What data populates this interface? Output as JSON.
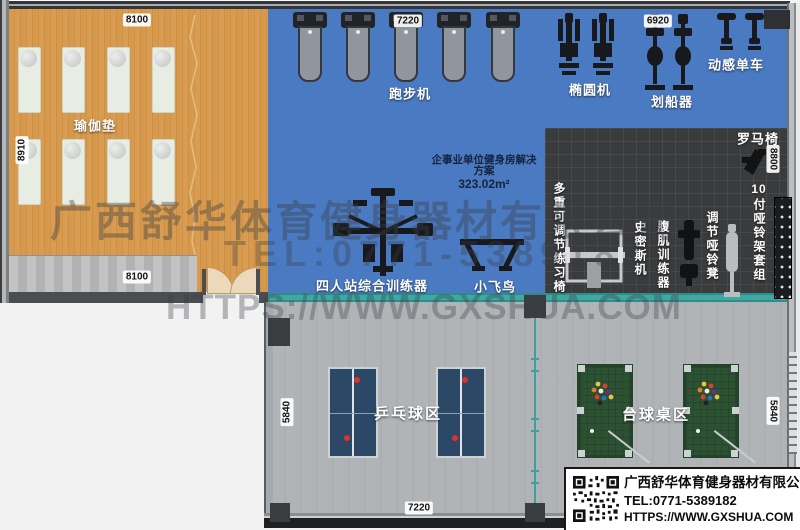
{
  "plan_title_note": {
    "line1": "企事业单位健身房解决",
    "line2": "方案",
    "area": "323.02m²"
  },
  "zones": {
    "yoga": {
      "label": "瑜伽垫",
      "mat_count": 8,
      "dim_top": "8100",
      "dim_left": "8910",
      "dim_bottom": "8100"
    },
    "cardio": {
      "treadmill_label": "跑步机",
      "treadmill_count": 5,
      "dim_top": "7220",
      "elliptical_label": "椭圆机",
      "elliptical_count": 2,
      "rower_label": "划船器",
      "rower_dim": "6920",
      "rower_count": 2,
      "spinbike_label": "动感单车",
      "spinbike_count": 2,
      "trainer4_label": "四人站综合训练器",
      "fly_label": "小飞鸟"
    },
    "strength": {
      "multi_bench_label": "多重可调节练习椅",
      "smith_label": "史密斯机",
      "ab_label": "腹肌训练器",
      "db_bench_label": "调节哑铃凳",
      "roman_label": "罗马椅",
      "db_rack_num": "10",
      "db_rack_text": "付哑铃架套组",
      "dim_right": "8800"
    },
    "recreation": {
      "pingpong_label": "乒乓球区",
      "pingpong_count": 2,
      "billiard_label": "台球桌区",
      "billiard_count": 2,
      "dim_left": "5840",
      "dim_right": "5840",
      "dim_bottom": "7220"
    }
  },
  "watermark": {
    "line1": "广西舒华体育健身器材有限公司",
    "line2": "TEL:0771-5389182",
    "line3": "HTTPS://WWW.GXSHUA.COM"
  },
  "info_box": {
    "qr_icon": "qr-code-icon",
    "company": "广西舒华体育健身器材有限公司",
    "tel": "TEL:0771-5389182",
    "url": "HTTPS://WWW.GXSHUA.COM"
  },
  "colors": {
    "yoga_floor": "#d79a4d",
    "cardio_floor": "#4a7ac2",
    "strength_floor": "#3a3b3d",
    "recreation_floor": "#b1b4b7",
    "teal_wall": "#41a7a2",
    "pingpong_table": "#2b4866",
    "billiard_table": "#2c5233",
    "ball_red": "#e03128"
  }
}
